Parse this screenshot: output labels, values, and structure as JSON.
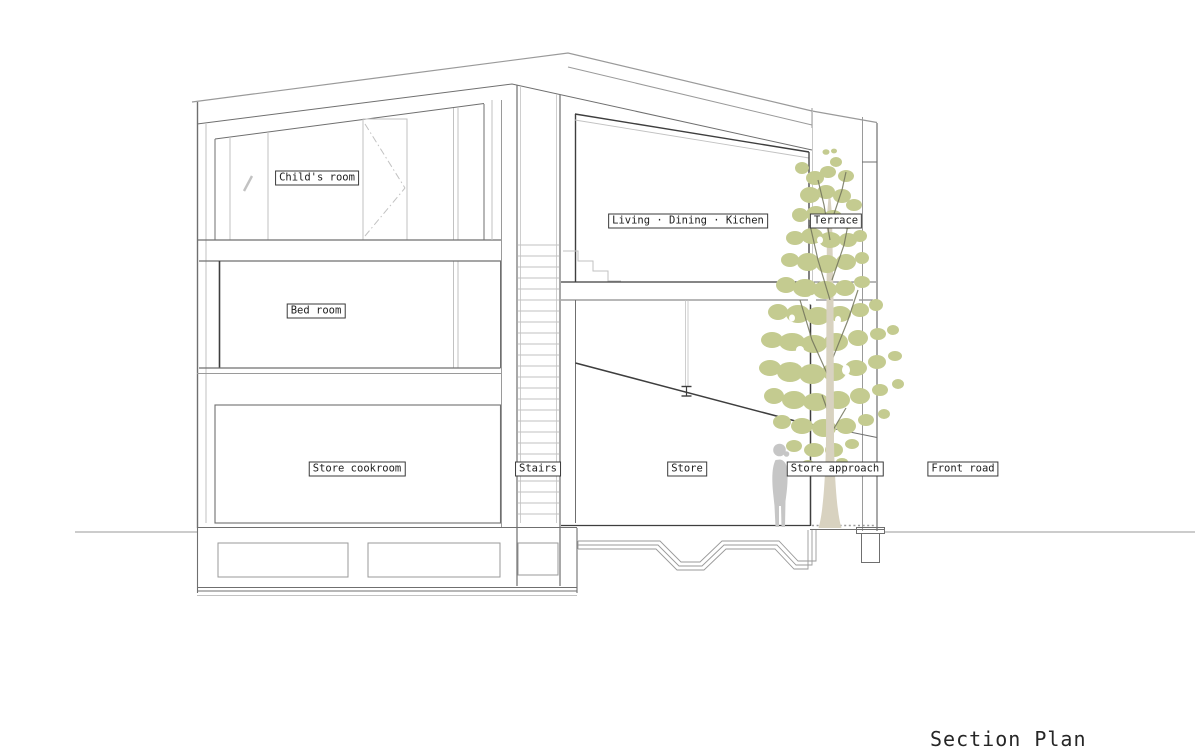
{
  "drawing": {
    "title": "Section Plan",
    "room_labels": {
      "childs_room": "Child's room",
      "bed_room": "Bed room",
      "store_cookroom": "Store cookroom",
      "stairs": "Stairs",
      "living_dining_kitchen": "Living · Dining · Kichen",
      "terrace": "Terrace",
      "store": "Store",
      "store_approach": "Store approach",
      "front_road": "Front road"
    },
    "colors": {
      "background": "#ffffff",
      "line_dark": "#3e3e3e",
      "line_med": "#6f6f6f",
      "line_light": "#9a9a9a",
      "line_faint": "#c2c2c2",
      "foliage": "#c4cb90",
      "branch": "#72745c",
      "trunk": "#d8d2c0",
      "person": "#c6c6c6"
    }
  }
}
